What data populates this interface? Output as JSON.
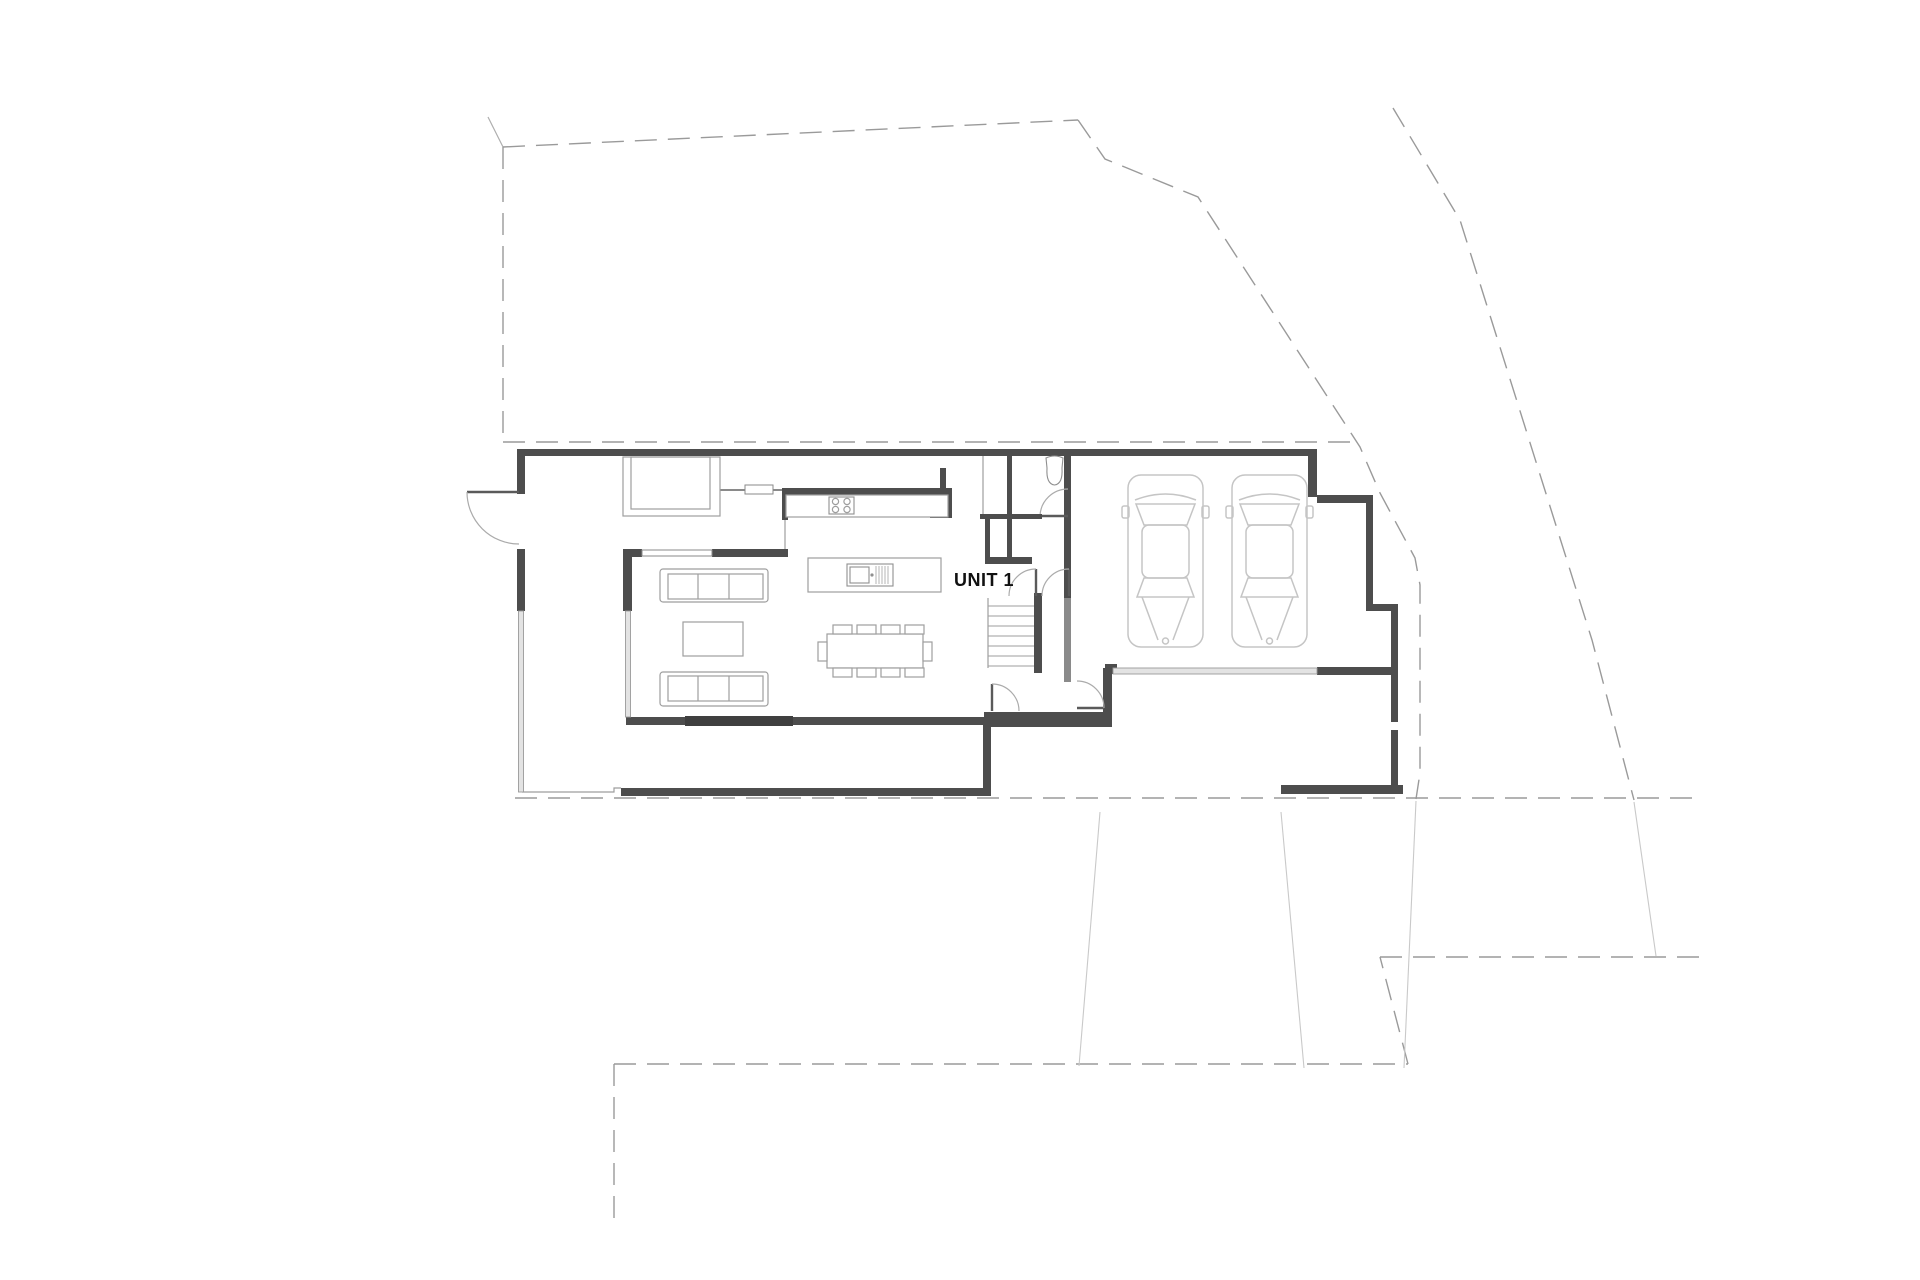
{
  "document": {
    "kind": "architectural-site-floor-plan",
    "unit_label": "UNIT 1"
  },
  "colors": {
    "background": "#ffffff",
    "wall": "#4d4d4d",
    "wall_dark": "#3f3f3f",
    "wall_light": "#8a8a8a",
    "window_fill": "#e3e3e3",
    "boundary_dash": "#9a9a9a",
    "driveway_faint": "#c9c9c9",
    "furniture_line": "#9e9e9e",
    "car_line": "#c5c5c5",
    "door_arc": "#ababab",
    "label_text": "#111111"
  },
  "plan_contents": {
    "cars_in_garage": 2,
    "dining_chairs": 10,
    "sofas": 2,
    "coffee_tables": 1,
    "kitchen_islands": 1,
    "cooktop_burners": 4,
    "toilets": 1,
    "door_swings": 6,
    "stair_flights": 2
  }
}
